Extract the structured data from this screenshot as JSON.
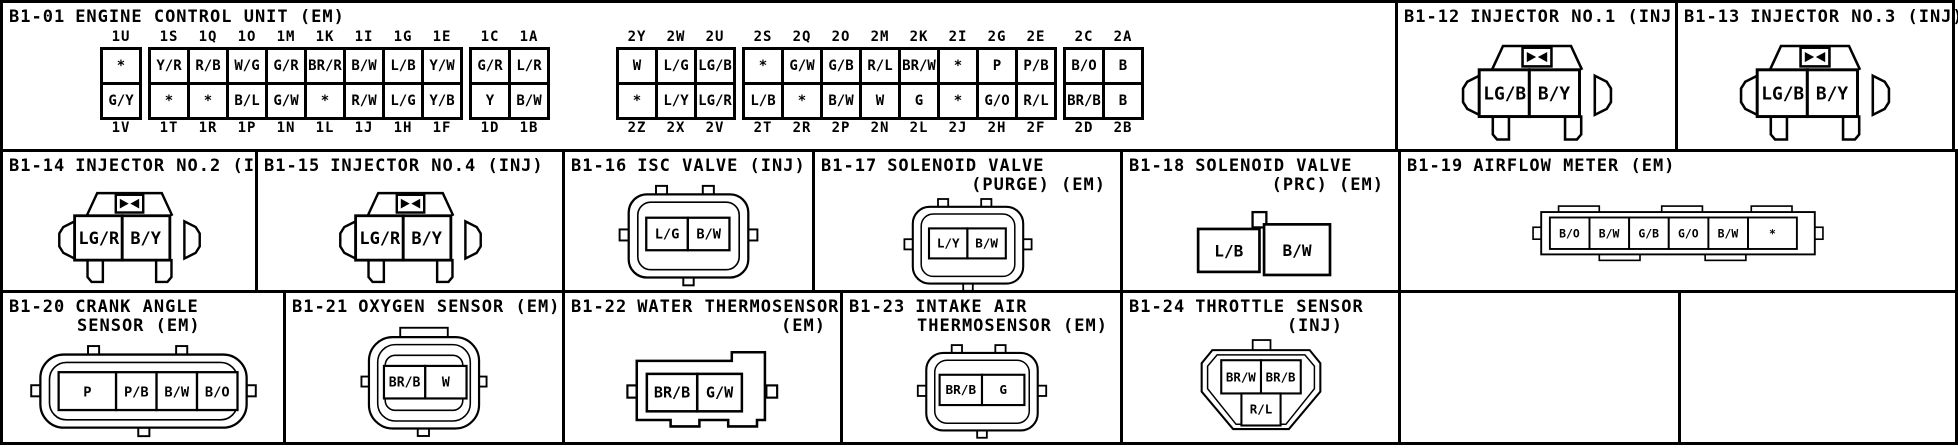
{
  "palette": {
    "ink": "#000000",
    "paper": "#ffffff"
  },
  "ecu": {
    "id": "B1-01",
    "name": "ENGINE CONTROL UNIT (EM)",
    "t1": {
      "groups": [
        {
          "cols": [
            {
              "top": "1U",
              "a": "*",
              "b": "G/Y",
              "bot": "1V"
            }
          ]
        },
        {
          "cols": [
            {
              "top": "1S",
              "a": "Y/R",
              "b": "*",
              "bot": "1T"
            },
            {
              "top": "1Q",
              "a": "R/B",
              "b": "*",
              "bot": "1R"
            },
            {
              "top": "1O",
              "a": "W/G",
              "b": "B/L",
              "bot": "1P"
            },
            {
              "top": "1M",
              "a": "G/R",
              "b": "G/W",
              "bot": "1N"
            },
            {
              "top": "1K",
              "a": "BR/R",
              "b": "*",
              "bot": "1L"
            },
            {
              "top": "1I",
              "a": "B/W",
              "b": "R/W",
              "bot": "1J"
            },
            {
              "top": "1G",
              "a": "L/B",
              "b": "L/G",
              "bot": "1H"
            },
            {
              "top": "1E",
              "a": "Y/W",
              "b": "Y/B",
              "bot": "1F"
            }
          ]
        },
        {
          "cols": [
            {
              "top": "1C",
              "a": "G/R",
              "b": "Y",
              "bot": "1D"
            },
            {
              "top": "1A",
              "a": "L/R",
              "b": "B/W",
              "bot": "1B"
            }
          ]
        }
      ]
    },
    "t2": {
      "groups": [
        {
          "cols": [
            {
              "top": "2Y",
              "a": "W",
              "b": "*",
              "bot": "2Z"
            },
            {
              "top": "2W",
              "a": "L/G",
              "b": "L/Y",
              "bot": "2X"
            },
            {
              "top": "2U",
              "a": "LG/B",
              "b": "LG/R",
              "bot": "2V"
            }
          ]
        },
        {
          "cols": [
            {
              "top": "2S",
              "a": "*",
              "b": "L/B",
              "bot": "2T"
            },
            {
              "top": "2Q",
              "a": "G/W",
              "b": "*",
              "bot": "2R"
            },
            {
              "top": "2O",
              "a": "G/B",
              "b": "B/W",
              "bot": "2P"
            },
            {
              "top": "2M",
              "a": "R/L",
              "b": "W",
              "bot": "2N"
            },
            {
              "top": "2K",
              "a": "BR/W",
              "b": "G",
              "bot": "2L"
            },
            {
              "top": "2I",
              "a": "*",
              "b": "*",
              "bot": "2J"
            },
            {
              "top": "2G",
              "a": "P",
              "b": "G/O",
              "bot": "2H"
            },
            {
              "top": "2E",
              "a": "P/B",
              "b": "R/L",
              "bot": "2F"
            }
          ]
        },
        {
          "cols": [
            {
              "top": "2C",
              "a": "B/O",
              "b": "BR/B",
              "bot": "2D"
            },
            {
              "top": "2A",
              "a": "B",
              "b": "B",
              "bot": "2B"
            }
          ]
        }
      ]
    }
  },
  "connectors": {
    "b112": {
      "id": "B1-12",
      "name": "INJECTOR NO.1 (INJ)",
      "pins": {
        "p1": "LG/B",
        "p2": "B/Y"
      }
    },
    "b113": {
      "id": "B1-13",
      "name": "INJECTOR NO.3 (INJ)",
      "pins": {
        "p1": "LG/B",
        "p2": "B/Y"
      }
    },
    "b114": {
      "id": "B1-14",
      "name": "INJECTOR NO.2 (INJ)",
      "pins": {
        "p1": "LG/R",
        "p2": "B/Y"
      }
    },
    "b115": {
      "id": "B1-15",
      "name": "INJECTOR NO.4 (INJ)",
      "pins": {
        "p1": "LG/R",
        "p2": "B/Y"
      }
    },
    "b116": {
      "id": "B1-16",
      "name": "ISC VALVE (INJ)",
      "pins": {
        "p1": "L/G",
        "p2": "B/W"
      }
    },
    "b117": {
      "id": "B1-17",
      "name": "SOLENOID VALVE",
      "sub": "(PURGE) (EM)",
      "pins": {
        "p1": "L/Y",
        "p2": "B/W"
      }
    },
    "b118": {
      "id": "B1-18",
      "name": "SOLENOID VALVE",
      "sub": "(PRC) (EM)",
      "pins": {
        "p1": "L/B",
        "p2": "B/W"
      }
    },
    "b119": {
      "id": "B1-19",
      "name": "AIRFLOW METER (EM)",
      "pins": {
        "p1": "B/O",
        "p2": "B/W",
        "p3": "G/B",
        "p4": "G/O",
        "p5": "B/W",
        "p6": "*"
      }
    },
    "b120": {
      "id": "B1-20",
      "name": "CRANK ANGLE",
      "sub": "SENSOR (EM)",
      "pins": {
        "p1": "P",
        "p2": "P/B",
        "p3": "B/W",
        "p4": "B/O"
      }
    },
    "b121": {
      "id": "B1-21",
      "name": "OXYGEN SENSOR (EM)",
      "pins": {
        "p1": "BR/B",
        "p2": "W"
      }
    },
    "b122": {
      "id": "B1-22",
      "name": "WATER THERMOSENSOR",
      "sub": "(EM)",
      "pins": {
        "p1": "BR/B",
        "p2": "G/W"
      }
    },
    "b123": {
      "id": "B1-23",
      "name": "INTAKE AIR",
      "sub": "THERMOSENSOR (EM)",
      "pins": {
        "p1": "BR/B",
        "p2": "G"
      }
    },
    "b124": {
      "id": "B1-24",
      "name": "THROTTLE SENSOR",
      "sub": "(INJ)",
      "pins": {
        "p1": "BR/W",
        "p2": "BR/B",
        "p3": "R/L"
      }
    }
  }
}
